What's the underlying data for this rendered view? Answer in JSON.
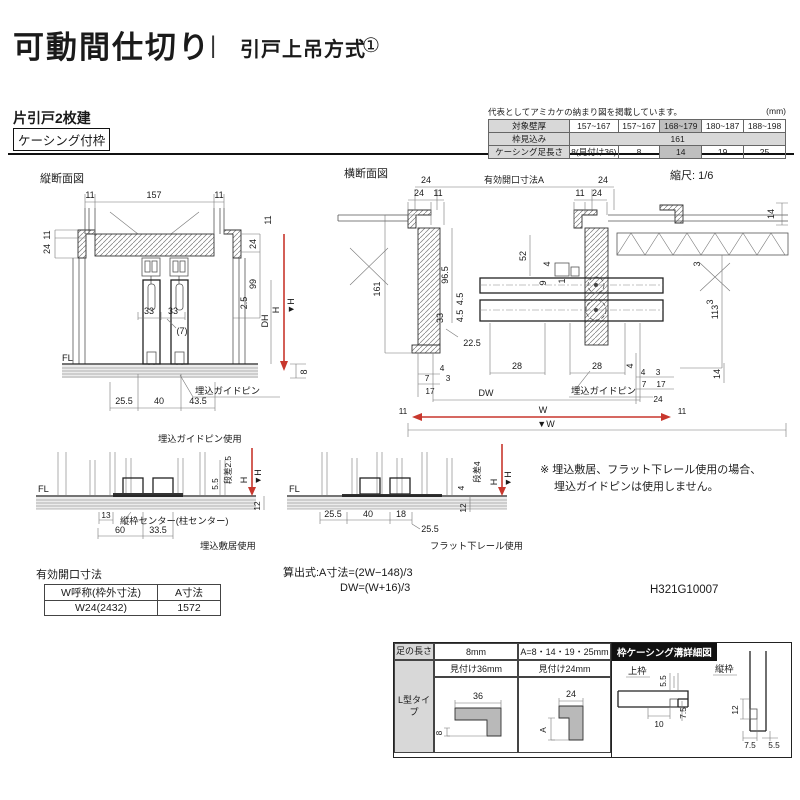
{
  "header": {
    "title": "可動間仕切り",
    "divider": "|",
    "subtitle": "引戸上吊方式",
    "num": "①",
    "type_label": "片引戸2枚建",
    "frame_label": "ケーシング付枠"
  },
  "spec_table": {
    "note": "代表としてアミカケの納まり図を掲載しています。",
    "unit": "(mm)",
    "row1_label": "対象壁厚",
    "row1": [
      "157~167",
      "157~167",
      "168~179",
      "180~187",
      "188~198"
    ],
    "row2_label": "枠見込み",
    "row2_value": "161",
    "row3_label": "ケーシング足長さ",
    "row3": [
      "8(見付け36)",
      "8",
      "14",
      "19",
      "25"
    ]
  },
  "vsec": {
    "title": "縦断面図",
    "fl": "FL",
    "pin_label": "埋込ガイドピン",
    "d": {
      "w11l": "11",
      "w157": "157",
      "w11r": "11",
      "l11": "11",
      "l24": "24",
      "r11": "11",
      "r24": "24",
      "r99": "99",
      "r25": "2.5",
      "dh": "DH",
      "h": "H",
      "vh": "▼H",
      "r8": "8",
      "m33a": "33",
      "m33b": "33",
      "m7": "(7)",
      "b255": "25.5",
      "b40": "40",
      "b435": "43.5"
    }
  },
  "hsec": {
    "title": "横断面図",
    "scale": "縮尺: 1/6",
    "open_label": "有効開口寸法A",
    "pin_label": "埋込ガイドピン",
    "d": {
      "t24l": "24",
      "t24r": "24",
      "s24l": "24",
      "s11l": "11",
      "s11r": "11",
      "s24r": "24",
      "r14t": "14",
      "l161": "161",
      "l965": "96.5",
      "l45a": "4.5",
      "l45b": "4.5",
      "l33": "33",
      "l225": "22.5",
      "c52": "52",
      "c4": "4",
      "c9": "9",
      "c1": "1",
      "r113": "113",
      "r3a": "3",
      "r3b": "3",
      "r14b": "14",
      "g28a": "28",
      "g28b": "28",
      "g4": "4",
      "bl4": "4",
      "bl7": "7",
      "bl3": "3",
      "bl17": "17",
      "bl11": "11",
      "br4": "4",
      "br3": "3",
      "br7": "7",
      "br17": "17",
      "br24": "24",
      "br11": "11",
      "dw": "DW",
      "w": "W",
      "vw": "▼W"
    }
  },
  "detailL": {
    "caption": "埋込ガイドピン使用",
    "name": "埋込敷居使用",
    "fl": "FL",
    "center": "縦枠センター(柱センター)",
    "d": {
      "step": "段差2.5",
      "d55": "5.5",
      "h": "H",
      "vh": "▼H",
      "d12": "12",
      "d13": "13",
      "d60": "60",
      "d335": "33.5"
    }
  },
  "detailM": {
    "name": "フラット下レール使用",
    "fl": "FL",
    "d": {
      "step": "段差4",
      "d4": "4",
      "h": "H",
      "vh": "▼H",
      "d12": "12",
      "d255a": "25.5",
      "d40": "40",
      "d18": "18",
      "d255b": "25.5"
    }
  },
  "note": {
    "line1": "※ 埋込敷居、フラット下レール使用の場合、",
    "line2": "埋込ガイドピンは使用しません。"
  },
  "open_table": {
    "title": "有効開口寸法",
    "h1": "W呼称(枠外寸法)",
    "h2": "A寸法",
    "v1": "W24(2432)",
    "v2": "1572"
  },
  "formula": {
    "l1": "算出式:A寸法=(2W−148)/3",
    "l2": "DW=(W+16)/3"
  },
  "doc_no": "H321G10007",
  "leg": {
    "h0": "足の長さ",
    "h1": "8mm",
    "h2": "A=8・14・19・25mm",
    "s1": "見付け36mm",
    "s2": "見付け24mm",
    "row_label": "L型タイプ",
    "d36": "36",
    "d8": "8",
    "d24": "24",
    "dA": "A"
  },
  "groove": {
    "title": "枠ケーシング溝詳細図",
    "top_label": "上枠",
    "side_label": "縦枠",
    "d55a": "5.5",
    "d75a": "7.5",
    "d10": "10",
    "d12": "12",
    "d75b": "7.5",
    "d55b": "5.5"
  },
  "colors": {
    "accent": "#c8372d",
    "ink": "#1a1a1a",
    "shade": "#d8d8d8",
    "shade2": "#bfbfbf"
  }
}
